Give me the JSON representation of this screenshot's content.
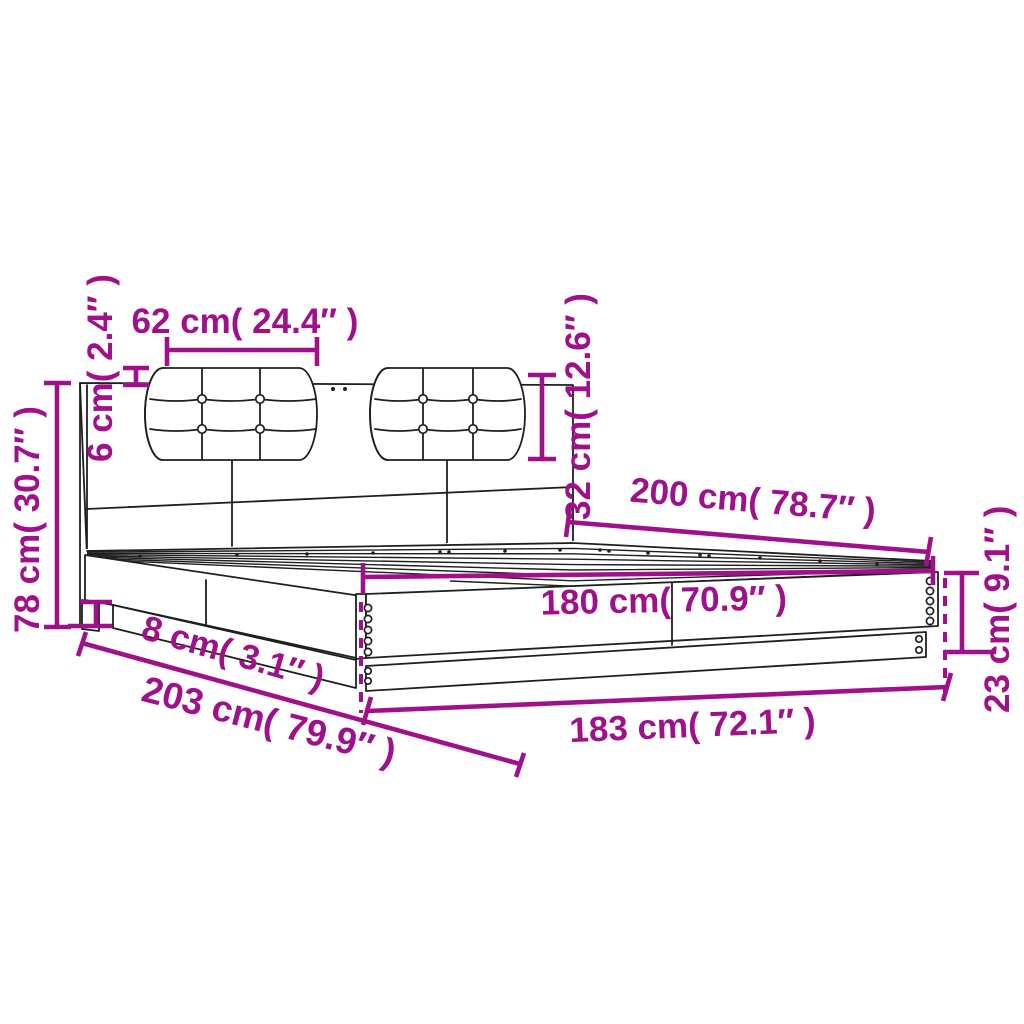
{
  "figure": {
    "type": "product-dimension-diagram",
    "subject": "bed frame with headboard and two tufted cushions",
    "background_color": "#ffffff",
    "drawing_line_color": "#1f1f1f",
    "dimension_color": "#a0108a"
  },
  "dimensions": [
    {
      "id": "cushion-width",
      "cm": 62,
      "inch": 24.4,
      "label": "62 cm( 24.4″ )"
    },
    {
      "id": "cushion-top-offset",
      "cm": 6,
      "inch": 2.4,
      "label": "6 cm( 2.4″ )"
    },
    {
      "id": "cushion-height",
      "cm": 32,
      "inch": 12.6,
      "label": "32 cm( 12.6″ )"
    },
    {
      "id": "headboard-height",
      "cm": 78,
      "inch": 30.7,
      "label": "78 cm( 30.7″ )"
    },
    {
      "id": "bed-length",
      "cm": 200,
      "inch": 78.7,
      "label": "200 cm( 78.7″ )"
    },
    {
      "id": "inner-width",
      "cm": 180,
      "inch": 70.9,
      "label": "180 cm( 70.9″ )"
    },
    {
      "id": "base-height",
      "cm": 8,
      "inch": 3.1,
      "label": "8 cm( 3.1″ )"
    },
    {
      "id": "total-length",
      "cm": 203,
      "inch": 79.9,
      "label": "203 cm( 79.9″ )"
    },
    {
      "id": "outer-width",
      "cm": 183,
      "inch": 72.1,
      "label": "183 cm( 72.1″ )"
    },
    {
      "id": "side-rail-height",
      "cm": 23,
      "inch": 9.1,
      "label": "23 cm( 9.1″ )"
    }
  ]
}
